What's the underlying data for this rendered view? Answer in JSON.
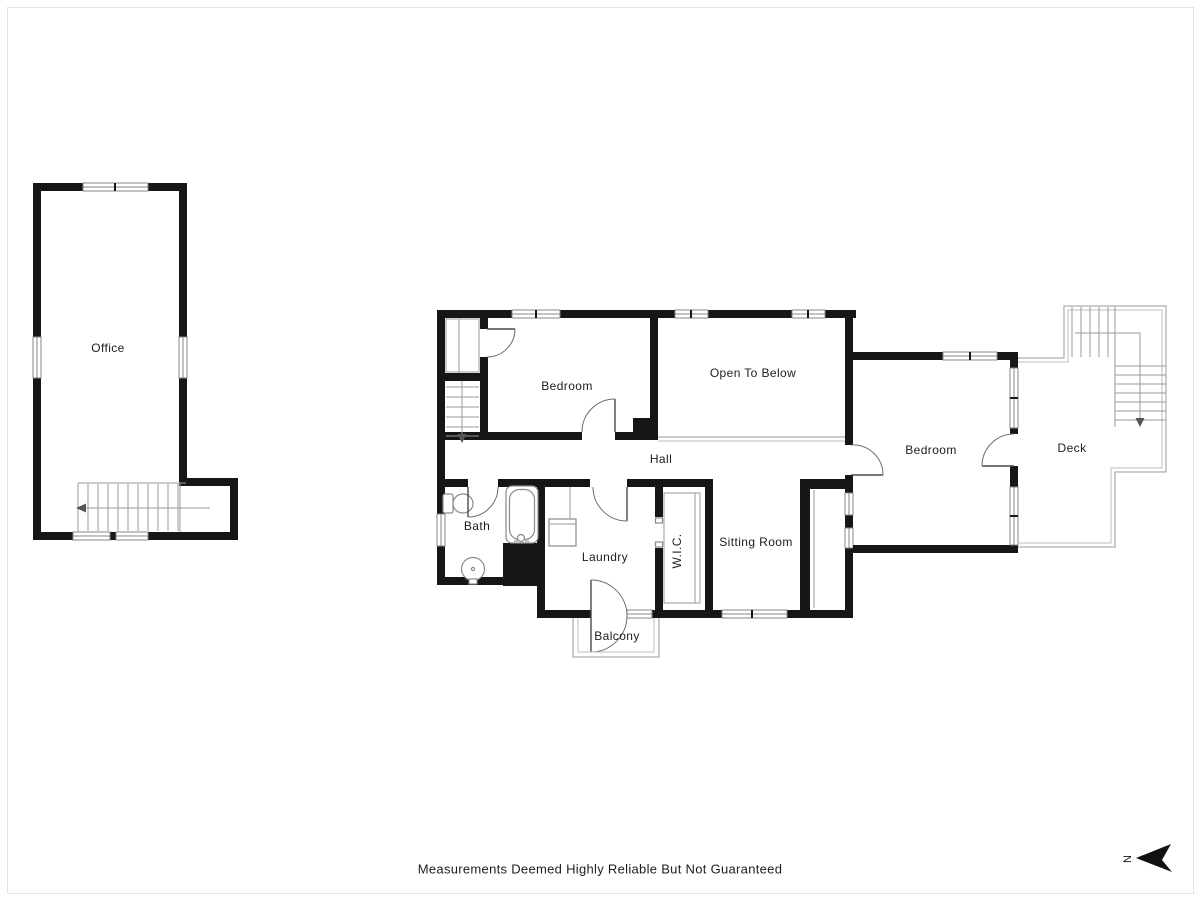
{
  "colors": {
    "wall": "#161616",
    "line": "#9a9a9a",
    "text": "#1d1d1d"
  },
  "rooms": {
    "office": "Office",
    "bedroom_left": "Bedroom",
    "open_to_below": "Open To Below",
    "hall": "Hall",
    "bath": "Bath",
    "laundry": "Laundry",
    "wic": "W.I.C.",
    "sitting_room": "Sitting Room",
    "bedroom_right": "Bedroom",
    "deck": "Deck",
    "balcony": "Balcony"
  },
  "compass": {
    "north_label": "N",
    "icon": "north-arrow-pointing-left"
  },
  "footer": {
    "disclaimer": "Measurements Deemed Highly Reliable But Not Guaranteed"
  }
}
